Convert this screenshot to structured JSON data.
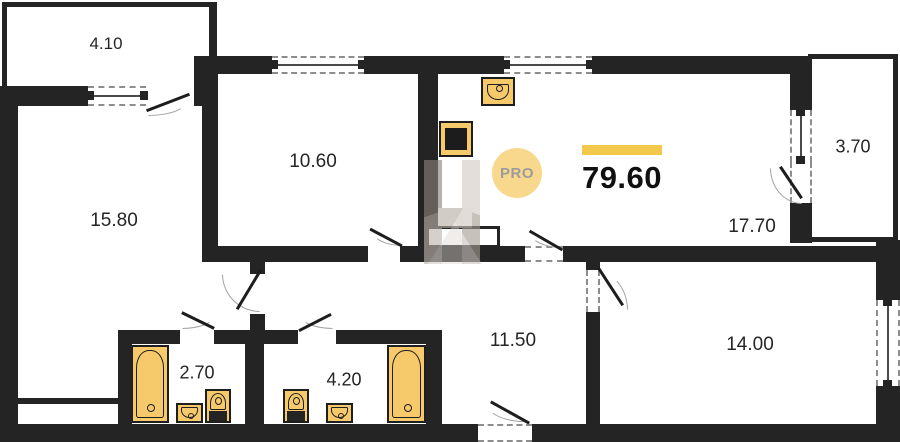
{
  "floorplan": {
    "total_area": "79.60",
    "watermark": {
      "badge_label": "PRO"
    },
    "rooms": {
      "balcony_top": {
        "label": "4.10"
      },
      "room_left": {
        "label": "15.80"
      },
      "room_top": {
        "label": "10.60"
      },
      "kitchen_living": {
        "label": "17.70"
      },
      "balcony_right": {
        "label": "3.70"
      },
      "hallway": {
        "label": "11.50"
      },
      "room_right": {
        "label": "14.00"
      },
      "bathroom_small": {
        "label": "2.70"
      },
      "bathroom_large": {
        "label": "4.20"
      }
    },
    "colors": {
      "wall": "#242424",
      "fixture_fill": "#f6c96b",
      "accent_bar": "#f2c94c",
      "badge_fill": "#f8d88c",
      "badge_text": "#9c9c9c"
    }
  }
}
